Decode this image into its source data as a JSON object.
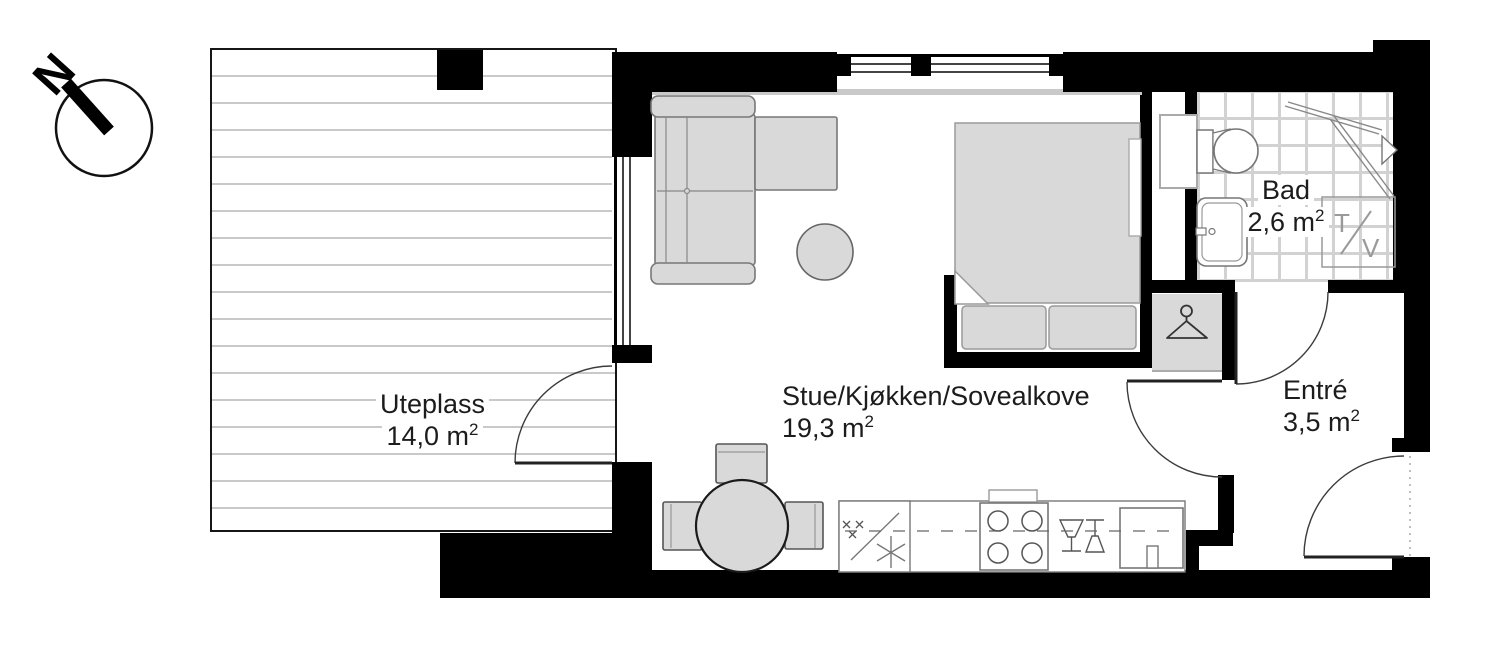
{
  "compass": {
    "label": "N"
  },
  "rooms": {
    "uteplass": {
      "name": "Uteplass",
      "area": "14,0 m",
      "area_sup": "2"
    },
    "stue": {
      "name": "Stue/Kjøkken/Sovealkove",
      "area": "19,3 m",
      "area_sup": "2"
    },
    "bad": {
      "name": "Bad",
      "area": "2,6 m",
      "area_sup": "2"
    },
    "entre": {
      "name": "Entré",
      "area": "3,5 m",
      "area_sup": "2"
    }
  },
  "bathroom": {
    "washer_left": "T",
    "washer_right": "V"
  },
  "colors": {
    "wall": "#000000",
    "furniture_fill": "#d9d9d9",
    "deck_line": "#c9c9c9",
    "tile_line": "#d2d2d2",
    "text": "#1c1c1c",
    "muted_label": "#9a9a9a"
  },
  "icons": {
    "compass_needle": "thick-diagonal-bar",
    "hanger": "clothes-hanger-outline",
    "shower_arrow": "right-arrow-triangle"
  }
}
